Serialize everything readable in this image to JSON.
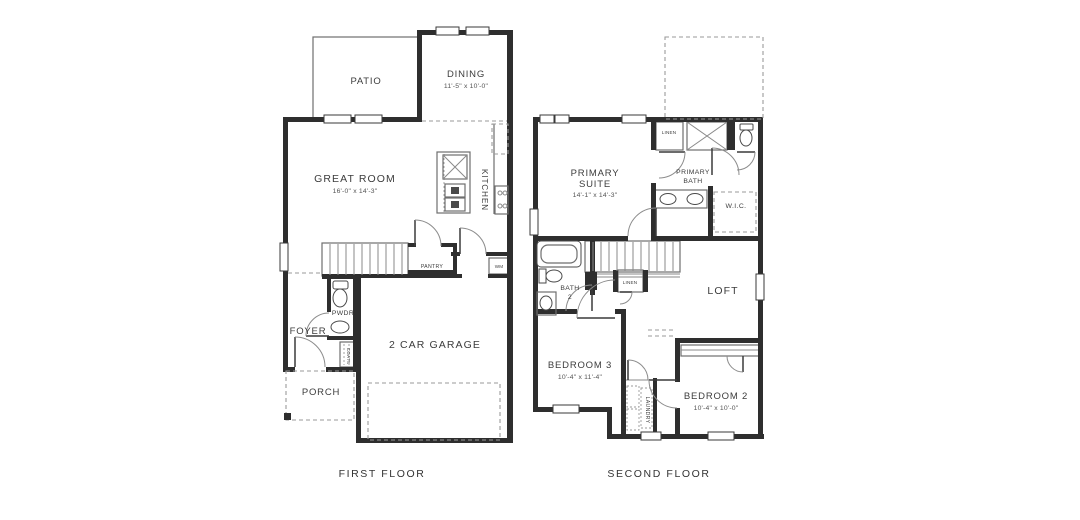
{
  "plans": {
    "first": {
      "caption": "FIRST FLOOR",
      "patio": "PATIO",
      "dining": "DINING",
      "dining_dims": "11'-5\" x 10'-0\"",
      "great_room": "GREAT ROOM",
      "great_room_dims": "16'-0\" x 14'-3\"",
      "kitchen": "KITCHEN",
      "pantry": "PANTRY",
      "wm": "WM",
      "pwdr": "PWDR",
      "foyer": "FOYER",
      "coats": "COATS",
      "porch": "PORCH",
      "garage": "2 CAR GARAGE"
    },
    "second": {
      "caption": "SECOND FLOOR",
      "primary_suite_1": "PRIMARY",
      "primary_suite_2": "SUITE",
      "primary_suite_dims": "14'-1\" x 14'-3\"",
      "linen_top": "LINEN",
      "primary_bath_1": "PRIMARY",
      "primary_bath_2": "BATH",
      "wic": "W.I.C.",
      "bath2_1": "BATH",
      "bath2_2": "2",
      "linen_mid": "LINEN",
      "loft": "LOFT",
      "bedroom3": "BEDROOM 3",
      "bedroom3_dims": "10'-4\" x 11'-4\"",
      "laundry": "LAUNDRY",
      "bedroom2": "BEDROOM 2",
      "bedroom2_dims": "10'-4\" x 10'-0\""
    }
  },
  "colors": {
    "wall": "#2e2e2e",
    "line": "#6e6e6e",
    "dashed": "#9a9a9a",
    "text": "#3c3c3c",
    "background": "#ffffff"
  }
}
